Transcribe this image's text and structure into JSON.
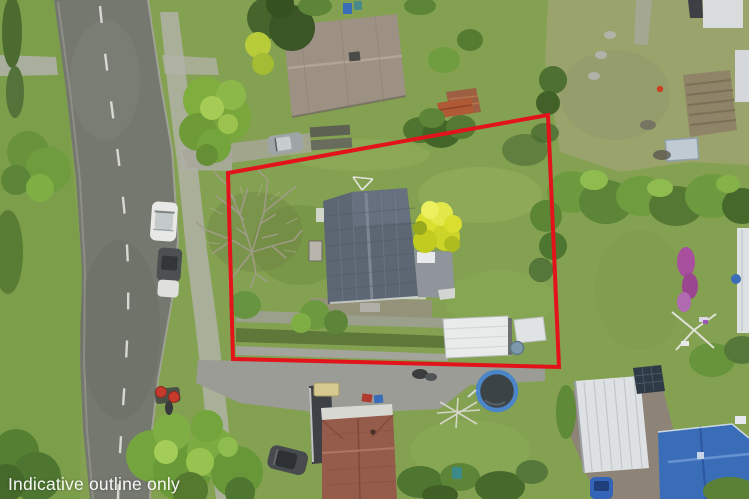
{
  "photo": {
    "kind": "aerial-drone-photo-of-residential-property",
    "disclaimer": "Indicative outline only"
  },
  "boundary": {
    "points": "228,173 548,115 559,367 233,359",
    "color": "#e2131b",
    "stroke_width": 4
  },
  "colors": {
    "base_lawn": "#83a150",
    "left_lawn": "#7c9d4a",
    "neighbor_lawn": "#99a36b",
    "road": "#75786f",
    "path": "#b3b3ab",
    "driveway": "#9b9c95",
    "dirt": "#8d8376",
    "roof_main": "#5d6774",
    "roof_ridge": "#7d8794",
    "roof_ext": "#8f959b",
    "roof_neighbor": "#9c9183",
    "deck": "#9c5f42",
    "doghouse": "#b05a35",
    "red_roof": "#955b4b",
    "red_roof_band": "#d8d8d2",
    "carport": "#3d4145",
    "shed_white": "#e9ebea",
    "big_shed": "#dde1e3",
    "solar": "#2e3a45",
    "blue_roof": "#3a6db8",
    "tree": "#6f9c3e",
    "tree_bright": "#8fbf4d",
    "tree_dark": "#45652c",
    "tree_yellow": "#d9de2f",
    "branches": "#a39c8d",
    "soil": "#8f8468",
    "purple_shrub": "#a8509d",
    "trampoline_mat": "#3c4347",
    "trampoline_ring": "#4a86c8",
    "car_white": "#e8e9e7",
    "car_silver": "#9fa5a7",
    "car_dark": "#474b4d",
    "car_blue": "#3464b8",
    "bin_red": "#c63a2d",
    "white_marking": "#e9e9e4"
  }
}
